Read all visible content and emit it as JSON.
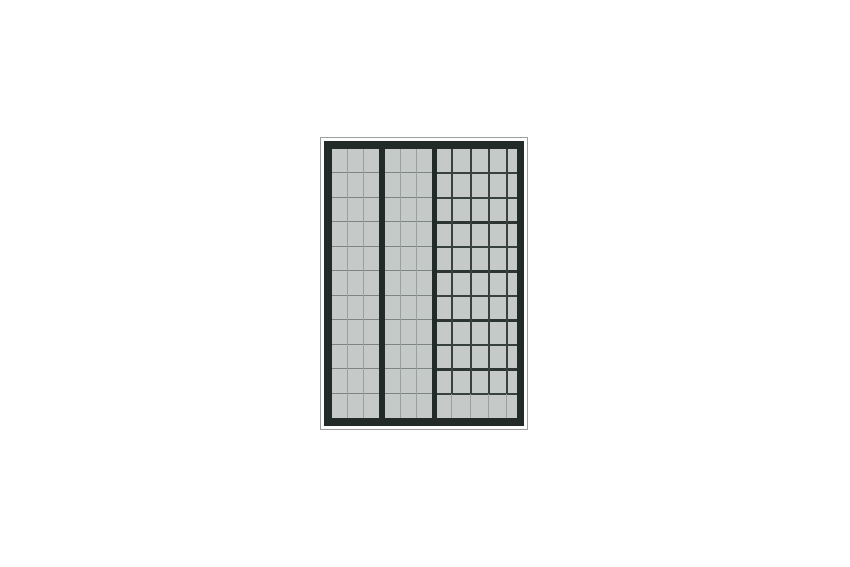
{
  "scene": {
    "background_color": "#ffffff",
    "panel": {
      "outline_color": "#9ca19f",
      "frame_color": "#222b27",
      "cell_color": "#c5c9c8",
      "light_vline_color": "#9aa09d",
      "light_hline_color": "#7d8481",
      "dark_line_color": "#38423d",
      "heavy_line_color": "#2c3531",
      "rows": 11,
      "divider_count": 2,
      "sections": [
        {
          "name": "left-grid",
          "columns": 3,
          "line_style": "light"
        },
        {
          "name": "middle-grid",
          "columns": 3,
          "line_style": "light"
        },
        {
          "name": "right-grid",
          "columns": 5,
          "line_style": "dark",
          "column_offsets_px": [
            14,
            33,
            51,
            69
          ],
          "bottom_row_line_style": "light",
          "heavy_row_boundaries": [
            3,
            5,
            7,
            9
          ]
        }
      ]
    }
  }
}
